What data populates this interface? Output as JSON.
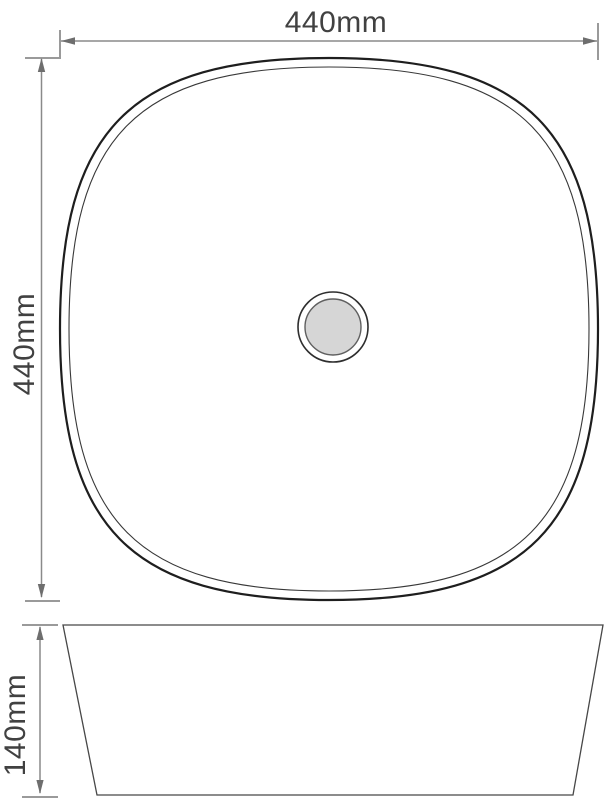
{
  "drawing": {
    "kind": "technical dimension drawing",
    "views": {
      "top_view": {
        "width_label": "440mm",
        "depth_label": "440mm"
      },
      "side_view": {
        "height_label": "140mm"
      }
    }
  },
  "colors": {
    "background": "#ffffff",
    "dimension_line": "#8a8a8a",
    "dimension_arrow": "#6e6e6e",
    "extension_line": "#9a9a9a",
    "label_text": "#414141",
    "basin_outline_outer": "#1e1e1e",
    "basin_outline_inner": "#383838",
    "side_view_outline": "#474747",
    "drain_outer_stroke": "#2e2e2e",
    "drain_inner_stroke": "#5f5f5f",
    "drain_fill": "#d6d6d6"
  }
}
